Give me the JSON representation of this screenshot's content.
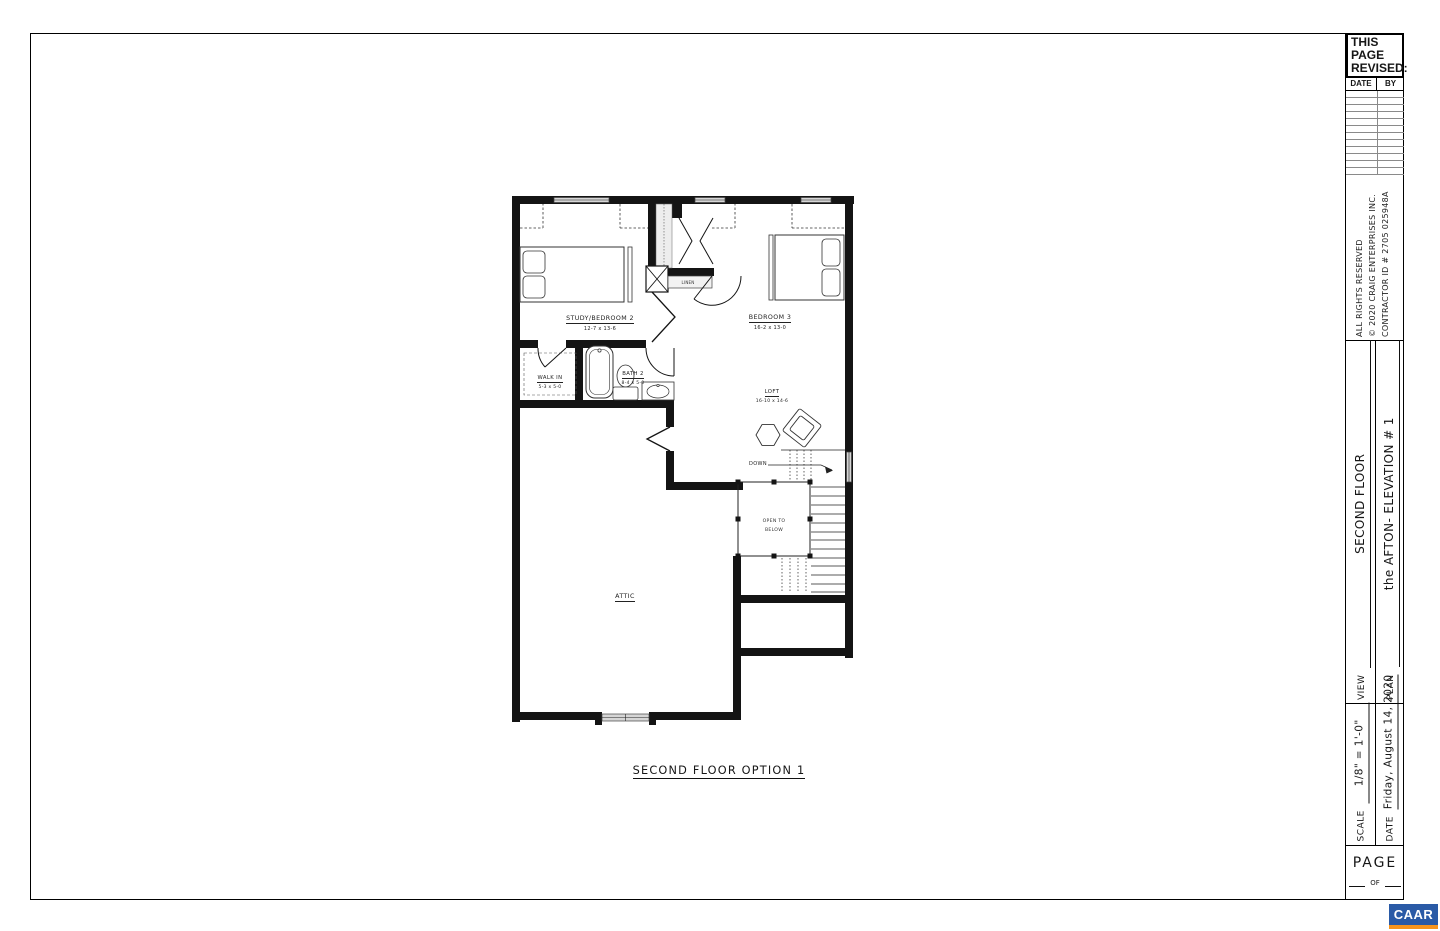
{
  "colors": {
    "ink": "#161616",
    "window_fill": "#d6d6d6",
    "logo_blue": "#2a5aa6",
    "logo_orange": "#f7941d"
  },
  "title_block": {
    "revision": {
      "title_line1": "THIS PAGE",
      "title_line2": "REVISED:",
      "col_date": "DATE",
      "col_by": "BY",
      "empty_row_count": 12
    },
    "copyright": {
      "line1": "ALL RIGHTS RESERVED",
      "line2": "© 2020 CRAIG ENTERPRISES INC.",
      "line3": "CONTRACTOR ID # 2705 025948A"
    },
    "view": {
      "label": "VIEW",
      "value": "SECOND FLOOR"
    },
    "plan": {
      "label": "PLAN",
      "value": "the AFTON- ELEVATION # 1"
    },
    "scale": {
      "label": "SCALE",
      "value": "1/8\" = 1'-0\""
    },
    "date": {
      "label": "DATE",
      "value": "Friday, August 14, 2020"
    },
    "page": {
      "label": "PAGE",
      "of_text": "OF"
    }
  },
  "floor_plan": {
    "caption": "SECOND FLOOR OPTION 1",
    "rooms": {
      "study_bedroom": {
        "name": "STUDY/BEDROOM 2",
        "dims": "12-7 x 13-6"
      },
      "bedroom3": {
        "name": "BEDROOM 3",
        "dims": "16-2 x 13-0"
      },
      "walk_in": {
        "name": "WALK IN",
        "dims": "5-3 x 5-0"
      },
      "bath2": {
        "name": "BATH 2",
        "dims": "8-4 x 5-0"
      },
      "loft": {
        "name": "LOFT",
        "dims": "16-10 x 14-6"
      },
      "attic": {
        "name": "ATTIC"
      }
    },
    "annotations": {
      "linen": "LINEN",
      "down": "DOWN",
      "open_to_below_line1": "OPEN TO",
      "open_to_below_line2": "BELOW"
    }
  },
  "logo": {
    "text": "CAAR"
  }
}
